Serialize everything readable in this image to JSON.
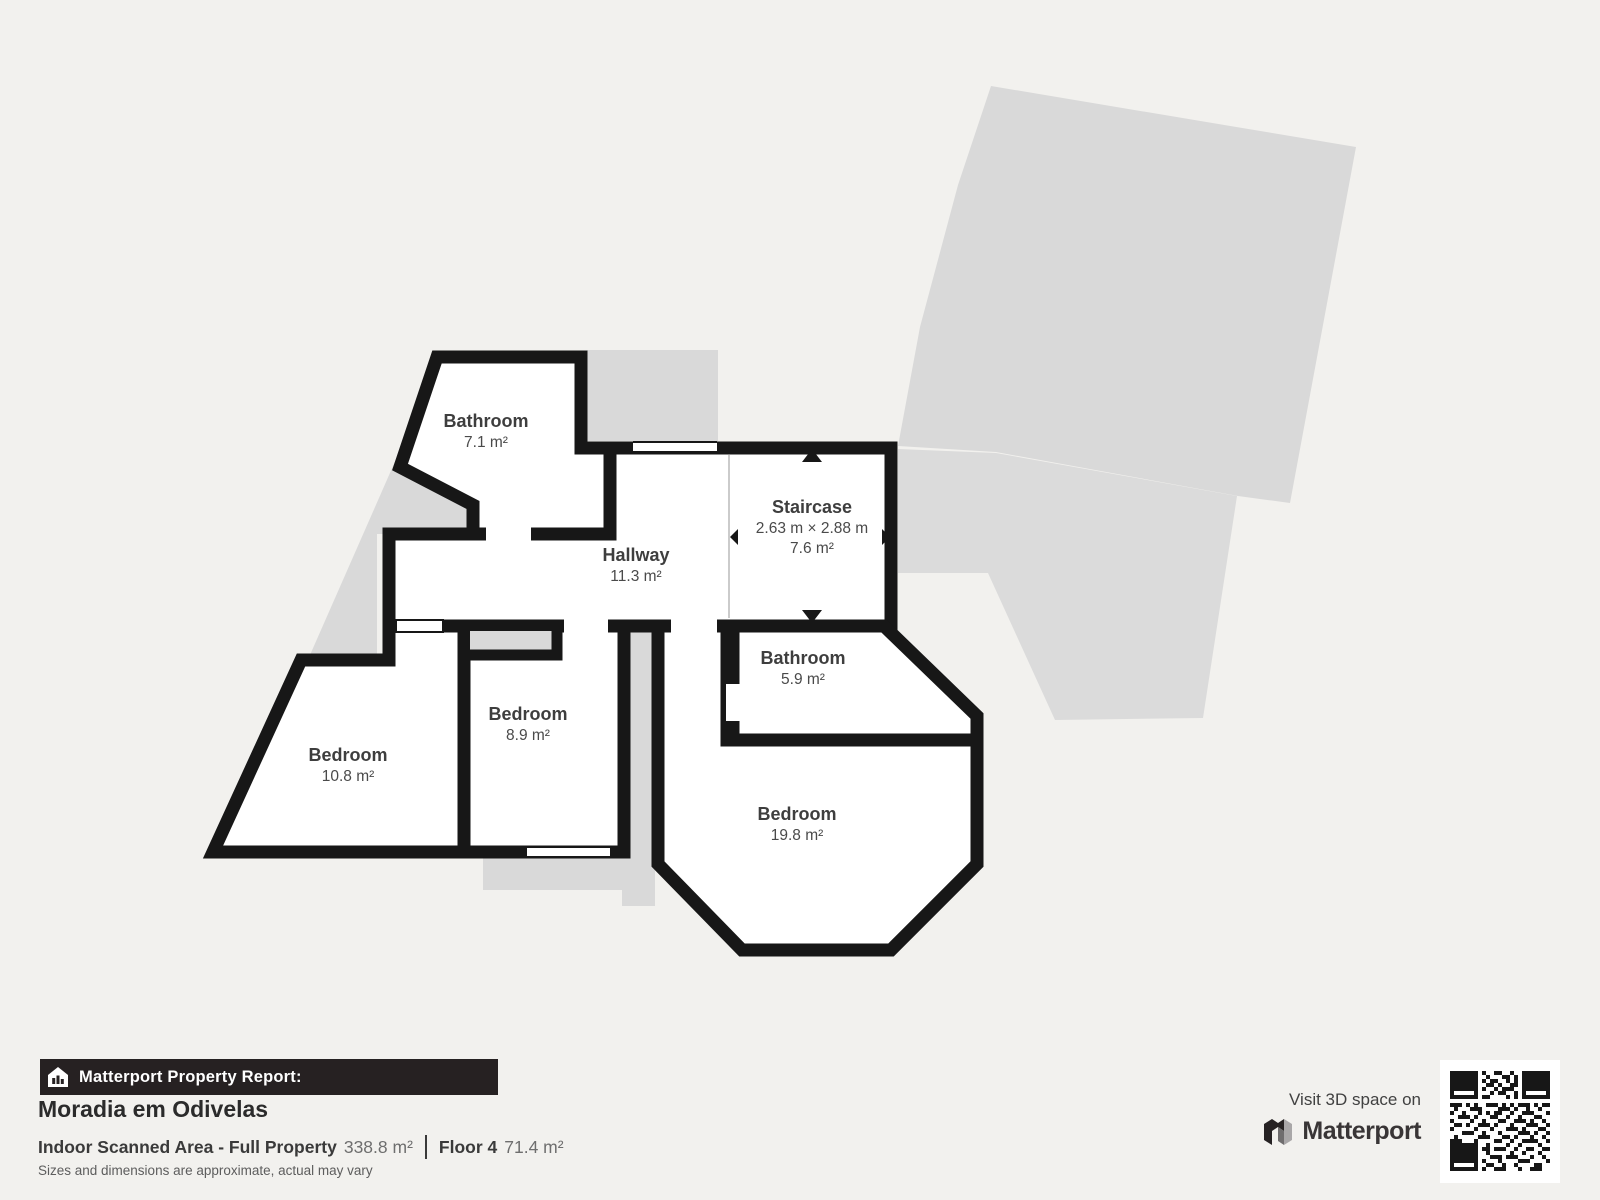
{
  "plan": {
    "rooms": [
      {
        "name": "Bathroom",
        "area": "7.1 m²"
      },
      {
        "name": "Staircase",
        "dims": "2.63 m × 2.88 m",
        "area": "7.6 m²"
      },
      {
        "name": "Hallway",
        "area": "11.3 m²"
      },
      {
        "name": "Bathroom",
        "area": "5.9 m²"
      },
      {
        "name": "Bedroom",
        "area": "8.9 m²"
      },
      {
        "name": "Bedroom",
        "area": "10.8 m²"
      },
      {
        "name": "Bedroom",
        "area": "19.8 m²"
      }
    ]
  },
  "footer": {
    "report_label": "Matterport Property Report:",
    "property_name": "Moradia em Odivelas",
    "scanned_area_label": "Indoor Scanned Area - Full Property",
    "scanned_area_value": "338.8 m²",
    "floor_label": "Floor 4",
    "floor_value": "71.4 m²",
    "disclaimer": "Sizes and dimensions are approximate, actual may vary",
    "visit_label": "Visit 3D space on",
    "brand": "Matterport"
  },
  "colors": {
    "background": "#f2f1ee",
    "wall": "#171717",
    "underlay": "#d9d9d9",
    "room_fill": "#ffffff",
    "bar_bg": "#262122",
    "label_text": "#3e3e3e"
  }
}
